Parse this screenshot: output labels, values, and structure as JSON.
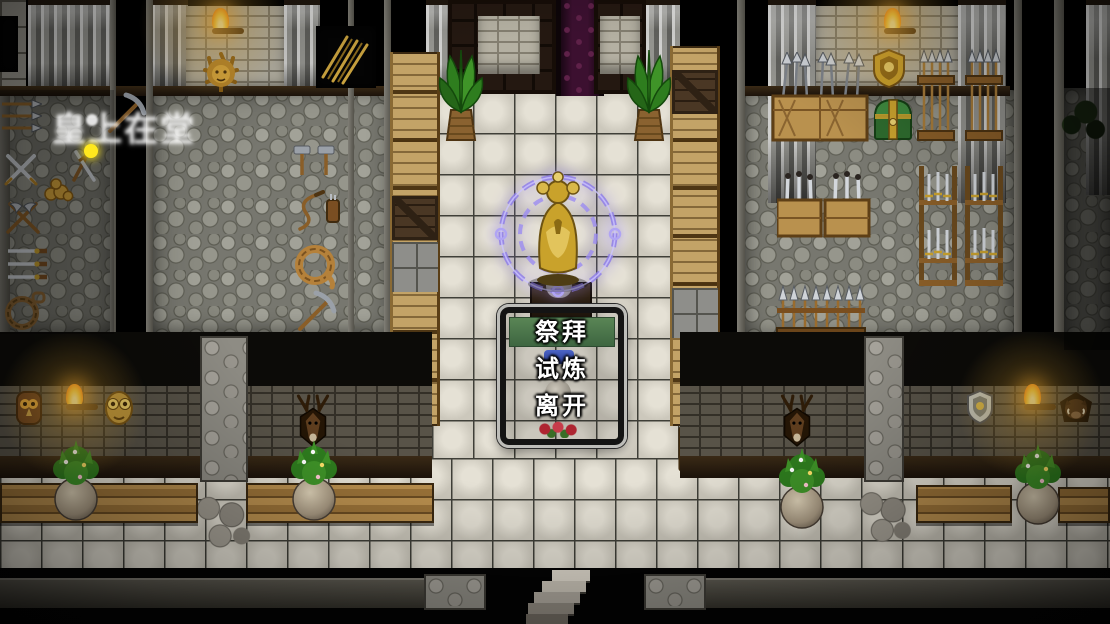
{
  "scene": {
    "name": "armory-temple-hall",
    "menu": {
      "items": [
        {
          "label": "祭拜",
          "selected": true
        },
        {
          "label": "试炼",
          "selected": false
        },
        {
          "label": "离开",
          "selected": false
        }
      ],
      "highlight_color": "#4d7a50",
      "text_color": "#ffffff"
    },
    "watermark": {
      "text": "皇上在堂"
    },
    "colors": {
      "background": "#000000",
      "floor_tile": "#d6d2c6",
      "cobblestone": "#8b8b83",
      "brick_wall": "#b4b0a2",
      "dark_brick": "#585348",
      "crate_wood": "#c3a367",
      "statue_gold": "#c9a22b",
      "aura_purple": "#8f7fe8",
      "torch_flame": "#ffd23e",
      "door_curtain_purple": "#3c1030",
      "chest_green": "#2e6b2e"
    },
    "icons": {
      "goddess-statue-icon": "gold goddess figure",
      "magic-aura-icon": "purple ritual rings",
      "torch-icon": "wall torch flame",
      "lion-head-icon": "gold lion ornament",
      "gold-shield-icon": "gold crest shield",
      "silver-shield-icon": "silver crest shield",
      "deer-trophy-icon": "mounted deer head",
      "owl-mask-icon": "carved owl mask",
      "gold-mask-icon": "gold owl mask",
      "boar-trophy-icon": "mounted boar head",
      "treasure-chest-icon": "green treasure chest",
      "stairs-icon": "descending staircase",
      "signboard-icon": "notice board"
    }
  }
}
